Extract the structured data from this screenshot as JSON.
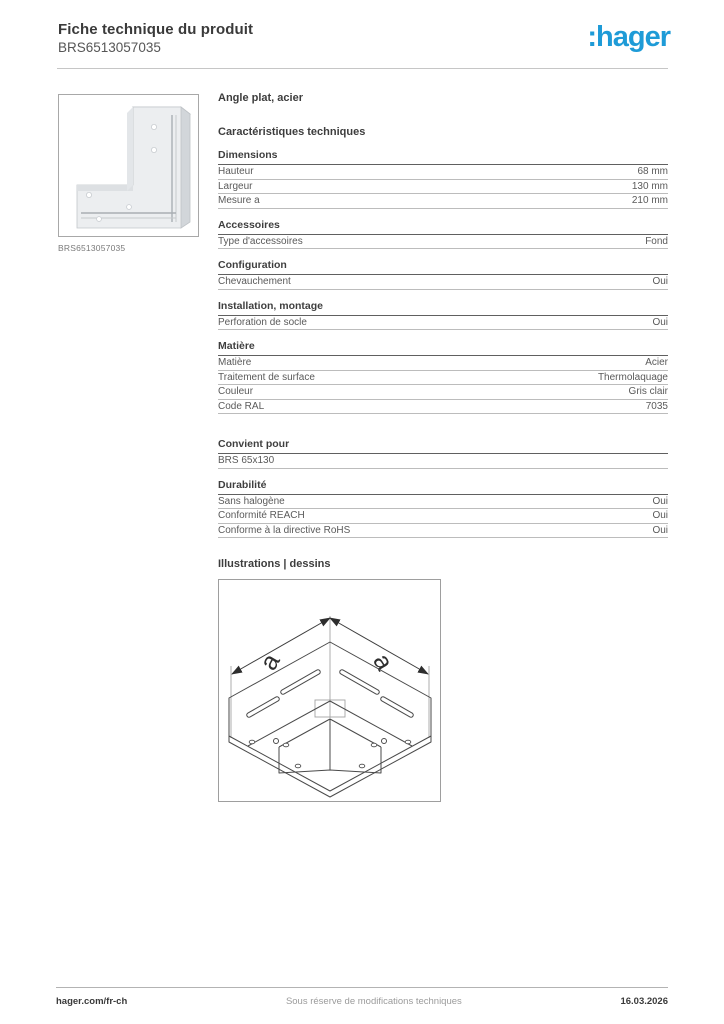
{
  "header": {
    "title": "Fiche technique du produit",
    "product_code": "BRS6513057035",
    "logo_text": ":hager",
    "logo_color": "#1e9bd7"
  },
  "left": {
    "image_caption": "BRS6513057035"
  },
  "spec": {
    "product_name": "Angle plat, acier",
    "heading": "Caractéristiques techniques",
    "groups": [
      {
        "title": "Dimensions",
        "gap_before": false,
        "rows": [
          {
            "label": "Hauteur",
            "value": "68 mm"
          },
          {
            "label": "Largeur",
            "value": "130 mm"
          },
          {
            "label": "Mesure a",
            "value": "210 mm"
          }
        ]
      },
      {
        "title": "Accessoires",
        "gap_before": false,
        "rows": [
          {
            "label": "Type d'accessoires",
            "value": "Fond"
          }
        ]
      },
      {
        "title": "Configuration",
        "gap_before": false,
        "rows": [
          {
            "label": "Chevauchement",
            "value": "Oui"
          }
        ]
      },
      {
        "title": "Installation, montage",
        "gap_before": false,
        "rows": [
          {
            "label": "Perforation de socle",
            "value": "Oui"
          }
        ]
      },
      {
        "title": "Matière",
        "gap_before": false,
        "rows": [
          {
            "label": "Matière",
            "value": "Acier"
          },
          {
            "label": "Traitement de surface",
            "value": "Thermolaquage"
          },
          {
            "label": "Couleur",
            "value": "Gris clair"
          },
          {
            "label": "Code RAL",
            "value": "7035"
          }
        ]
      },
      {
        "title": "Convient pour",
        "gap_before": true,
        "rows": [
          {
            "label": "BRS 65x130",
            "value": ""
          }
        ]
      },
      {
        "title": "Durabilité",
        "gap_before": false,
        "rows": [
          {
            "label": "Sans halogène",
            "value": "Oui"
          },
          {
            "label": "Conformité REACH",
            "value": "Oui"
          },
          {
            "label": "Conforme à la directive RoHS",
            "value": "Oui"
          }
        ]
      }
    ]
  },
  "illustrations": {
    "heading": "Illustrations | dessins",
    "dim_label": "a"
  },
  "footer": {
    "site": "hager.com/fr-ch",
    "disclaimer": "Sous réserve de modifications techniques",
    "date": "16.03.2026"
  }
}
